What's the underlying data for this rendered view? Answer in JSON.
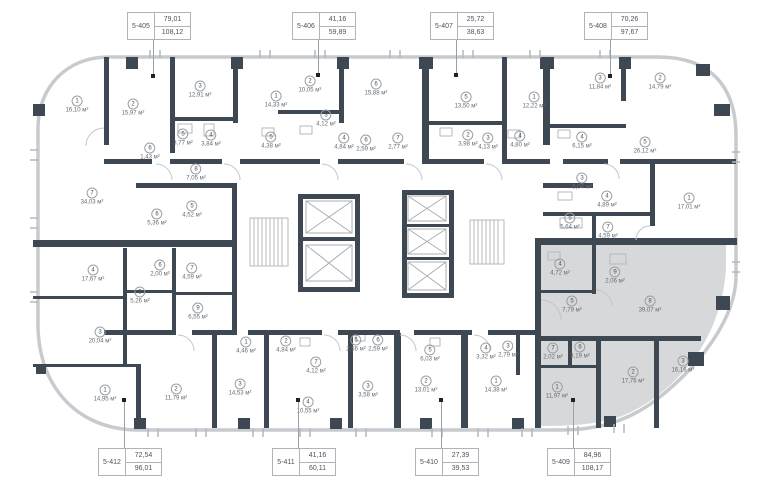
{
  "plan": {
    "title": "floor-plan",
    "area_unit": "м²",
    "selected_unit": "5-409",
    "colors": {
      "wall": "#3e4852",
      "facade": "#c7cbcf",
      "highlight": "#d7d8d9",
      "label_text": "#4d545a"
    },
    "units_top": [
      {
        "id": "5-405",
        "living": "79,01",
        "total": "108,12",
        "dot_x": 153,
        "dot_y": 76
      },
      {
        "id": "5-406",
        "living": "41,16",
        "total": "59,89",
        "dot_x": 318,
        "dot_y": 75
      },
      {
        "id": "5-407",
        "living": "25,72",
        "total": "38,63",
        "dot_x": 456,
        "dot_y": 75
      },
      {
        "id": "5-408",
        "living": "70,26",
        "total": "97,67",
        "dot_x": 610,
        "dot_y": 76
      }
    ],
    "units_bottom": [
      {
        "id": "5-412",
        "living": "72,54",
        "total": "96,01",
        "dot_x": 124,
        "dot_y": 400
      },
      {
        "id": "5-411",
        "living": "41,16",
        "total": "60,11",
        "dot_x": 298,
        "dot_y": 400
      },
      {
        "id": "5-410",
        "living": "27,39",
        "total": "39,53",
        "dot_x": 441,
        "dot_y": 400
      },
      {
        "id": "5-409",
        "living": "84,96",
        "total": "108,17",
        "dot_x": 573,
        "dot_y": 400,
        "selected": true
      }
    ],
    "rooms": [
      {
        "n": "1",
        "a": "16,10",
        "x": 77,
        "y": 105
      },
      {
        "n": "2",
        "a": "15,97",
        "x": 133,
        "y": 108
      },
      {
        "n": "3",
        "a": "12,91",
        "x": 200,
        "y": 90
      },
      {
        "n": "5",
        "a": "3,77",
        "x": 183,
        "y": 138
      },
      {
        "n": "4",
        "a": "3,84",
        "x": 211,
        "y": 139
      },
      {
        "n": "6",
        "a": "1,43",
        "x": 150,
        "y": 152
      },
      {
        "n": "8",
        "a": "7,05",
        "x": 196,
        "y": 173
      },
      {
        "n": "6",
        "a": "5,36",
        "x": 157,
        "y": 218
      },
      {
        "n": "5",
        "a": "4,52",
        "x": 192,
        "y": 210
      },
      {
        "n": "7",
        "a": "34,03",
        "x": 92,
        "y": 197
      },
      {
        "n": "1",
        "a": "14,33",
        "x": 276,
        "y": 100
      },
      {
        "n": "2",
        "a": "10,05",
        "x": 310,
        "y": 85
      },
      {
        "n": "6",
        "a": "15,88",
        "x": 376,
        "y": 88
      },
      {
        "n": "3",
        "a": "4,12",
        "x": 326,
        "y": 119
      },
      {
        "n": "5",
        "a": "4,38",
        "x": 271,
        "y": 141
      },
      {
        "n": "4",
        "a": "4,84",
        "x": 344,
        "y": 142
      },
      {
        "n": "6",
        "a": "2,59",
        "x": 366,
        "y": 144
      },
      {
        "n": "7",
        "a": "2,77",
        "x": 398,
        "y": 142
      },
      {
        "n": "5",
        "a": "13,50",
        "x": 466,
        "y": 101
      },
      {
        "n": "2",
        "a": "3,98",
        "x": 468,
        "y": 139
      },
      {
        "n": "3",
        "a": "4,13",
        "x": 488,
        "y": 142
      },
      {
        "n": "4",
        "a": "4,80",
        "x": 520,
        "y": 140
      },
      {
        "n": "1",
        "a": "12,22",
        "x": 534,
        "y": 101
      },
      {
        "n": "3",
        "a": "11,84",
        "x": 600,
        "y": 82
      },
      {
        "n": "2",
        "a": "14,79",
        "x": 660,
        "y": 82
      },
      {
        "n": "4",
        "a": "6,15",
        "x": 582,
        "y": 141
      },
      {
        "n": "5",
        "a": "26,12",
        "x": 645,
        "y": 146
      },
      {
        "n": "3",
        "a": "5,04",
        "x": 582,
        "y": 182
      },
      {
        "n": "4",
        "a": "4,89",
        "x": 607,
        "y": 200
      },
      {
        "n": "5",
        "a": "5,64",
        "x": 570,
        "y": 222
      },
      {
        "n": "7",
        "a": "4,59",
        "x": 608,
        "y": 231
      },
      {
        "n": "1",
        "a": "17,01",
        "x": 689,
        "y": 202
      },
      {
        "n": "4",
        "a": "17,67",
        "x": 93,
        "y": 274
      },
      {
        "n": "5",
        "a": "5,26",
        "x": 140,
        "y": 296
      },
      {
        "n": "6",
        "a": "2,00",
        "x": 160,
        "y": 269
      },
      {
        "n": "7",
        "a": "4,59",
        "x": 192,
        "y": 272
      },
      {
        "n": "9",
        "a": "6,55",
        "x": 198,
        "y": 312
      },
      {
        "n": "3",
        "a": "20,04",
        "x": 100,
        "y": 336
      },
      {
        "n": "1",
        "a": "14,95",
        "x": 105,
        "y": 394
      },
      {
        "n": "2",
        "a": "11,79",
        "x": 176,
        "y": 393
      },
      {
        "n": "3",
        "a": "14,53",
        "x": 240,
        "y": 388
      },
      {
        "n": "1",
        "a": "4,46",
        "x": 246,
        "y": 346
      },
      {
        "n": "2",
        "a": "4,84",
        "x": 286,
        "y": 345
      },
      {
        "n": "7",
        "a": "4,12",
        "x": 316,
        "y": 366
      },
      {
        "n": "4",
        "a": "10,55",
        "x": 308,
        "y": 406
      },
      {
        "n": "5",
        "a": "2,56",
        "x": 356,
        "y": 344
      },
      {
        "n": "6",
        "a": "2,59",
        "x": 378,
        "y": 344
      },
      {
        "n": "3",
        "a": "3,58",
        "x": 368,
        "y": 390
      },
      {
        "n": "5",
        "a": "6,03",
        "x": 430,
        "y": 354
      },
      {
        "n": "2",
        "a": "13,01",
        "x": 426,
        "y": 385
      },
      {
        "n": "4",
        "a": "3,32",
        "x": 486,
        "y": 352
      },
      {
        "n": "3",
        "a": "2,79",
        "x": 508,
        "y": 350
      },
      {
        "n": "1",
        "a": "14,38",
        "x": 496,
        "y": 385
      },
      {
        "n": "4",
        "a": "4,72",
        "x": 560,
        "y": 268
      },
      {
        "n": "9",
        "a": "2,06",
        "x": 615,
        "y": 276
      },
      {
        "n": "5",
        "a": "7,79",
        "x": 572,
        "y": 305
      },
      {
        "n": "8",
        "a": "39,07",
        "x": 650,
        "y": 305
      },
      {
        "n": "7",
        "a": "2,02",
        "x": 553,
        "y": 352
      },
      {
        "n": "6",
        "a": "3,19",
        "x": 580,
        "y": 351
      },
      {
        "n": "1",
        "a": "11,97",
        "x": 557,
        "y": 391
      },
      {
        "n": "2",
        "a": "17,76",
        "x": 633,
        "y": 376
      },
      {
        "n": "3",
        "a": "16,16",
        "x": 683,
        "y": 365
      }
    ]
  }
}
